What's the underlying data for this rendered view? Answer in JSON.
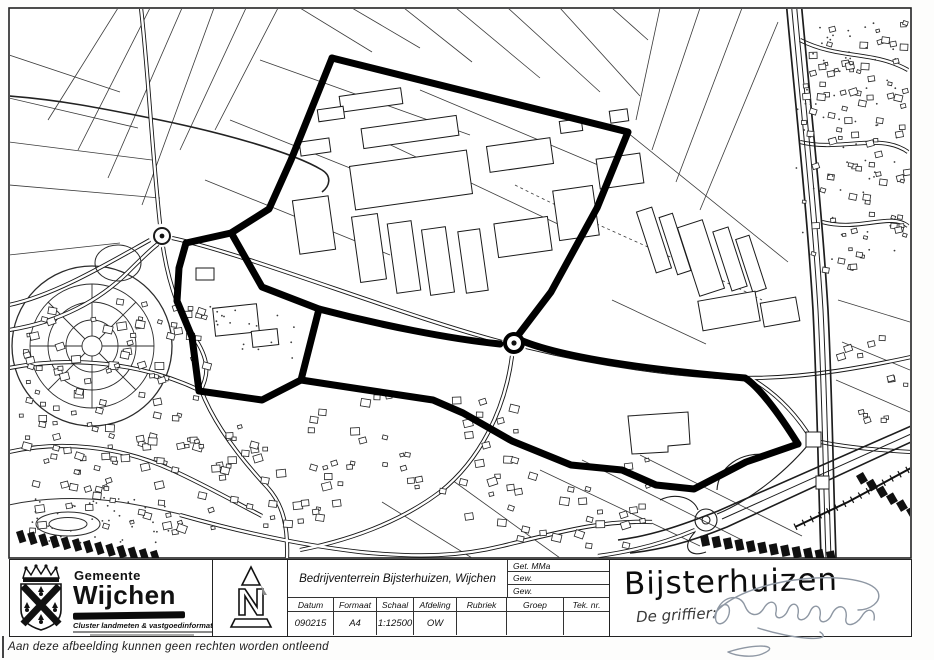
{
  "colors": {
    "ink": "#161616",
    "boundary": "#000000",
    "paper": "#ffffff",
    "pencil": "#8e97a3"
  },
  "icons": {
    "coat_of_arms": "wijchen-crest",
    "surveyor_logo": "pyramid-n-logo"
  },
  "map": {
    "kind": "scanned cadastral line map, business park outlined with thick boundary"
  },
  "title_block": {
    "municipality": {
      "line1": "Gemeente",
      "line2": "Wijchen",
      "department": "Cluster landmeten & vastgoedinformatie"
    },
    "project_title": "Bedrijventerrein Bijsterhuizen, Wijchen",
    "revisions": [
      "Get. MMa",
      "Gew.",
      "Gew."
    ],
    "columns": [
      {
        "label": "Datum",
        "value": "090215"
      },
      {
        "label": "Formaat",
        "value": "A4"
      },
      {
        "label": "Schaal",
        "value": "1:12500"
      },
      {
        "label": "Afdeling",
        "value": "OW"
      },
      {
        "label": "Rubriek",
        "value": ""
      },
      {
        "label": "Groep",
        "value": ""
      },
      {
        "label": "Tek. nr.",
        "value": ""
      }
    ],
    "plan_name": "Bijsterhuizen",
    "signature_label": "De griffier:",
    "signature_text": "Berendsen"
  },
  "footer": {
    "disclaimer": "Aan deze afbeelding kunnen geen rechten worden ontleend"
  }
}
